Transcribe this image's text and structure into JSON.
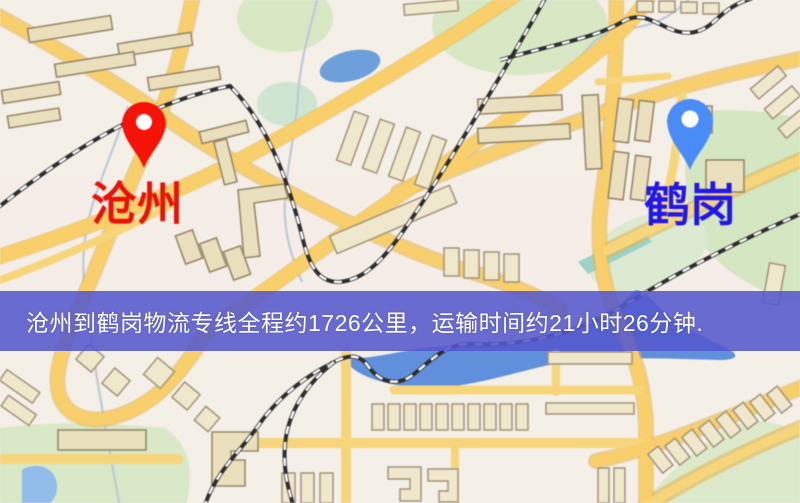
{
  "banner": {
    "text": "沧州到鹤岗物流专线全程约1726公里，运输时间约21小时26分钟.",
    "bg_color": "#5457cd",
    "text_color": "#ffffff"
  },
  "markers": {
    "origin": {
      "name": "沧州",
      "label_color": "#e21408",
      "pin_color": "#ee1408"
    },
    "destination": {
      "name": "鹤岗",
      "label_color": "#2218df",
      "pin_color": "#4b8cf3"
    }
  },
  "map_colors": {
    "background": "#f4efe7",
    "road": "#f6cf6e",
    "building": "#eae0bf",
    "green_area": "#d8e8c6",
    "water": "#6290d8",
    "railway": "#2e2e2e"
  }
}
